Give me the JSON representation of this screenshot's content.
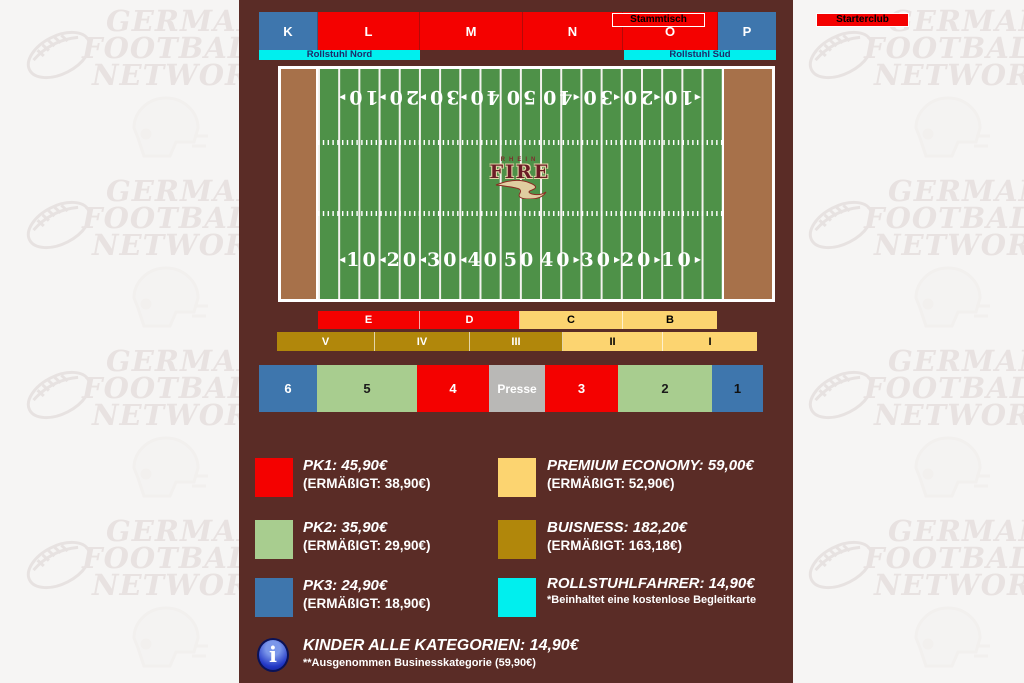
{
  "top_stand": {
    "sections": [
      {
        "label": "K"
      },
      {
        "label": "L"
      },
      {
        "label": "M"
      },
      {
        "label": "N"
      },
      {
        "label": "O"
      },
      {
        "label": "P"
      }
    ],
    "club_boxes": [
      {
        "label": "Stammtisch"
      },
      {
        "label": "Starterclub"
      }
    ],
    "wheelchair_zones": [
      {
        "label": "Rollstuhl Nord"
      },
      {
        "label": "Rollstuhl Süd"
      }
    ]
  },
  "field": {
    "team_name_small": "RHEIN",
    "team_name_large": "FIRE",
    "yard_numbers": [
      "10",
      "20",
      "30",
      "40",
      "50",
      "40",
      "30",
      "20",
      "10"
    ],
    "arrow_left": "◀",
    "arrow_right": "▶"
  },
  "mid_rows": {
    "letter_sections": [
      {
        "label": "E"
      },
      {
        "label": "D"
      },
      {
        "label": "C"
      },
      {
        "label": "B"
      }
    ],
    "roman_sections": [
      {
        "label": "V"
      },
      {
        "label": "IV"
      },
      {
        "label": "III"
      },
      {
        "label": "II"
      },
      {
        "label": "I"
      }
    ]
  },
  "south_stand": {
    "sections": [
      {
        "label": "6"
      },
      {
        "label": "5"
      },
      {
        "label": "4"
      },
      {
        "label": "Presse"
      },
      {
        "label": "3"
      },
      {
        "label": "2"
      },
      {
        "label": "1"
      }
    ]
  },
  "legend": {
    "items": [
      {
        "id": "pk1",
        "color": "#f40100",
        "title": "PK1: 45,90€",
        "subtitle": "(ERMÄßIGT: 38,90€)"
      },
      {
        "id": "premium",
        "color": "#fcd470",
        "title": "PREMIUM ECONOMY: 59,00€",
        "subtitle": "(ERMÄßIGT: 52,90€)"
      },
      {
        "id": "pk2",
        "color": "#a8cd8f",
        "title": "PK2: 35,90€",
        "subtitle": "(ERMÄßIGT: 29,90€)"
      },
      {
        "id": "business",
        "color": "#b1870b",
        "title": "BUISNESS: 182,20€",
        "subtitle": "(ERMÄßIGT: 163,18€)"
      },
      {
        "id": "pk3",
        "color": "#3e76ad",
        "title": "PK3: 24,90€",
        "subtitle": "(ERMÄßIGT: 18,90€)"
      },
      {
        "id": "rollstuhl",
        "color": "#00efee",
        "title": "ROLLSTUHLFAHRER: 14,90€",
        "subtitle": "*Beinhaltet eine kostenlose Begleitkarte"
      }
    ],
    "kinder": {
      "info_glyph": "i",
      "title": "KINDER ALLE KATEGORIEN: 14,90€",
      "subtitle": "**Ausgenommen Businesskategorie (59,90€)"
    }
  },
  "watermark": {
    "lines": [
      "GERMAN",
      "FOOTBALL",
      "NETWORK"
    ]
  },
  "colors": {
    "panel_background": "#5a2c26",
    "pk1_red": "#f40100",
    "pk2_green": "#a8cd8f",
    "pk3_blue": "#3e76ad",
    "premium_yellow": "#fcd470",
    "business_gold": "#b1870b",
    "wheelchair_cyan": "#00efee",
    "presse_gray": "#b9b8b6",
    "field_green": "#4e9148",
    "endzone_brown": "#a7714a"
  }
}
